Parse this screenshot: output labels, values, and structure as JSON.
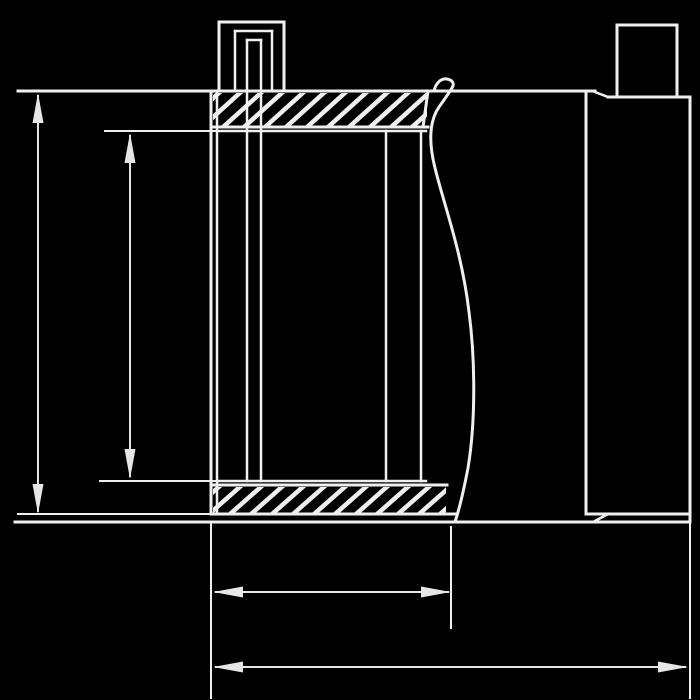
{
  "canvas": {
    "width": 700,
    "height": 700,
    "background": "#000000"
  },
  "drawing": {
    "kind": "technical-cross-section",
    "subject": "pipe coupling cross-section with top test port, broken pipe (break line) and unlabeled dimension lines",
    "stroke_color": "#efefef",
    "dim_color": "#e6e6e6",
    "segments": [
      {
        "name": "top-outline-and-extension",
        "x1": 18,
        "y1": 91,
        "x2": 595,
        "y2": 91,
        "w": 3
      },
      {
        "name": "top-step-chamfer",
        "x1": 595,
        "y1": 92,
        "x2": 608,
        "y2": 97,
        "w": 2.5
      },
      {
        "name": "top-right-edge",
        "x1": 608,
        "y1": 97,
        "x2": 690,
        "y2": 97,
        "w": 3
      },
      {
        "name": "right-end-face",
        "x1": 690,
        "y1": 97,
        "x2": 690,
        "y2": 522,
        "w": 3
      },
      {
        "name": "bottom-outline-long",
        "x1": 15,
        "y1": 522,
        "x2": 690,
        "y2": 522,
        "w": 3
      },
      {
        "name": "bottom-step-chamfer",
        "x1": 595,
        "y1": 521,
        "x2": 608,
        "y2": 514,
        "w": 2.5
      },
      {
        "name": "right-shoulder-line",
        "x1": 586,
        "y1": 514,
        "x2": 690,
        "y2": 514,
        "w": 3
      },
      {
        "name": "right-seam-line",
        "x1": 586,
        "y1": 92,
        "x2": 586,
        "y2": 514,
        "w": 3
      },
      {
        "name": "stub-left-edge",
        "x1": 617,
        "y1": 25,
        "x2": 617,
        "y2": 97,
        "w": 3
      },
      {
        "name": "stub-right-edge",
        "x1": 677,
        "y1": 25,
        "x2": 677,
        "y2": 97,
        "w": 3
      },
      {
        "name": "stub-top-edge",
        "x1": 617,
        "y1": 25,
        "x2": 677,
        "y2": 25,
        "w": 3
      },
      {
        "name": "coupling-left-wall-outer",
        "x1": 211,
        "y1": 91,
        "x2": 211,
        "y2": 514,
        "w": 3
      },
      {
        "name": "coupling-left-wall-inner",
        "x1": 217,
        "y1": 91,
        "x2": 217,
        "y2": 514,
        "w": 2.5
      },
      {
        "name": "top-flange-bottom-edge",
        "x1": 211,
        "y1": 127,
        "x2": 428,
        "y2": 127,
        "w": 3
      },
      {
        "name": "inner-top-line",
        "x1": 217,
        "y1": 131,
        "x2": 426,
        "y2": 131,
        "w": 2.5
      },
      {
        "name": "inner-bottom-line",
        "x1": 217,
        "y1": 481,
        "x2": 426,
        "y2": 481,
        "w": 2.5
      },
      {
        "name": "bottom-flange-top-edge",
        "x1": 211,
        "y1": 485,
        "x2": 447,
        "y2": 485,
        "w": 3
      },
      {
        "name": "bottom-flange-bottom-edge",
        "x1": 211,
        "y1": 514,
        "x2": 456,
        "y2": 514,
        "w": 3
      },
      {
        "name": "top-flange-right-closure",
        "x1": 428,
        "y1": 91,
        "x2": 423,
        "y2": 127,
        "w": 3
      },
      {
        "name": "bore-wall-left",
        "x1": 247,
        "y1": 40,
        "x2": 247,
        "y2": 481,
        "w": 2.5
      },
      {
        "name": "bore-wall-right",
        "x1": 261,
        "y1": 40,
        "x2": 261,
        "y2": 481,
        "w": 2.5
      },
      {
        "name": "bore-top-edge",
        "x1": 247,
        "y1": 40,
        "x2": 261,
        "y2": 40,
        "w": 2.5
      },
      {
        "name": "port-outer-left",
        "x1": 219,
        "y1": 22,
        "x2": 219,
        "y2": 91,
        "w": 3
      },
      {
        "name": "port-outer-right",
        "x1": 284,
        "y1": 22,
        "x2": 284,
        "y2": 91,
        "w": 3
      },
      {
        "name": "port-outer-top",
        "x1": 219,
        "y1": 22,
        "x2": 284,
        "y2": 22,
        "w": 3
      },
      {
        "name": "port-inner-left",
        "x1": 235,
        "y1": 31,
        "x2": 235,
        "y2": 91,
        "w": 2.5
      },
      {
        "name": "port-inner-right",
        "x1": 272,
        "y1": 31,
        "x2": 272,
        "y2": 91,
        "w": 2.5
      },
      {
        "name": "port-inner-top",
        "x1": 235,
        "y1": 31,
        "x2": 272,
        "y2": 31,
        "w": 2.5
      },
      {
        "name": "sleeve-wall-inner",
        "x1": 386,
        "y1": 131,
        "x2": 386,
        "y2": 481,
        "w": 2.5
      },
      {
        "name": "sleeve-wall-outer",
        "x1": 421,
        "y1": 131,
        "x2": 421,
        "y2": 481,
        "w": 2.5
      },
      {
        "name": "ext-line-coupling-bottom",
        "x1": 18,
        "y1": 514,
        "x2": 211,
        "y2": 514,
        "w": 2
      },
      {
        "name": "ext-line-bore-top",
        "x1": 105,
        "y1": 131,
        "x2": 217,
        "y2": 131,
        "w": 2
      },
      {
        "name": "ext-line-bore-bottom",
        "x1": 100,
        "y1": 481,
        "x2": 217,
        "y2": 481,
        "w": 2
      },
      {
        "name": "ext-line-length-left",
        "x1": 211,
        "y1": 522,
        "x2": 211,
        "y2": 698,
        "w": 2
      },
      {
        "name": "ext-line-length-mid",
        "x1": 451,
        "y1": 527,
        "x2": 451,
        "y2": 628,
        "w": 2
      },
      {
        "name": "ext-line-length-right",
        "x1": 690,
        "y1": 522,
        "x2": 690,
        "y2": 698,
        "w": 2
      }
    ],
    "break_line_path": "M 434 91 C 436 82 442 78 447 79 C 452 80 455 83 452 88 C 449 93 444 100 439 107 C 430 120 428 140 435 168 C 444 205 462 252 469 312 C 475 357 476 420 468 468 C 463 494 459 510 455 522",
    "hatch_bands": [
      {
        "name": "top-flange-hatch",
        "x": 213,
        "y": 93,
        "w": 214,
        "h": 33,
        "spacing": 21,
        "stroke_w": 4.5
      },
      {
        "name": "bottom-flange-hatch",
        "x": 213,
        "y": 487,
        "w": 233,
        "h": 26,
        "spacing": 21,
        "stroke_w": 4.5
      }
    ],
    "dimensions": [
      {
        "name": "dim-coupling-height",
        "type": "v",
        "x": 38,
        "a": 93,
        "b": 514,
        "label": ""
      },
      {
        "name": "dim-bore-height",
        "type": "v",
        "x": 130,
        "a": 133,
        "b": 479,
        "label": ""
      },
      {
        "name": "dim-coupling-length",
        "type": "h",
        "y": 592,
        "a": 213,
        "b": 451,
        "label": ""
      },
      {
        "name": "dim-overall-length",
        "type": "h",
        "y": 667,
        "a": 213,
        "b": 688,
        "label": ""
      }
    ],
    "arrow": {
      "length": 30,
      "half_width": 5.5
    }
  }
}
